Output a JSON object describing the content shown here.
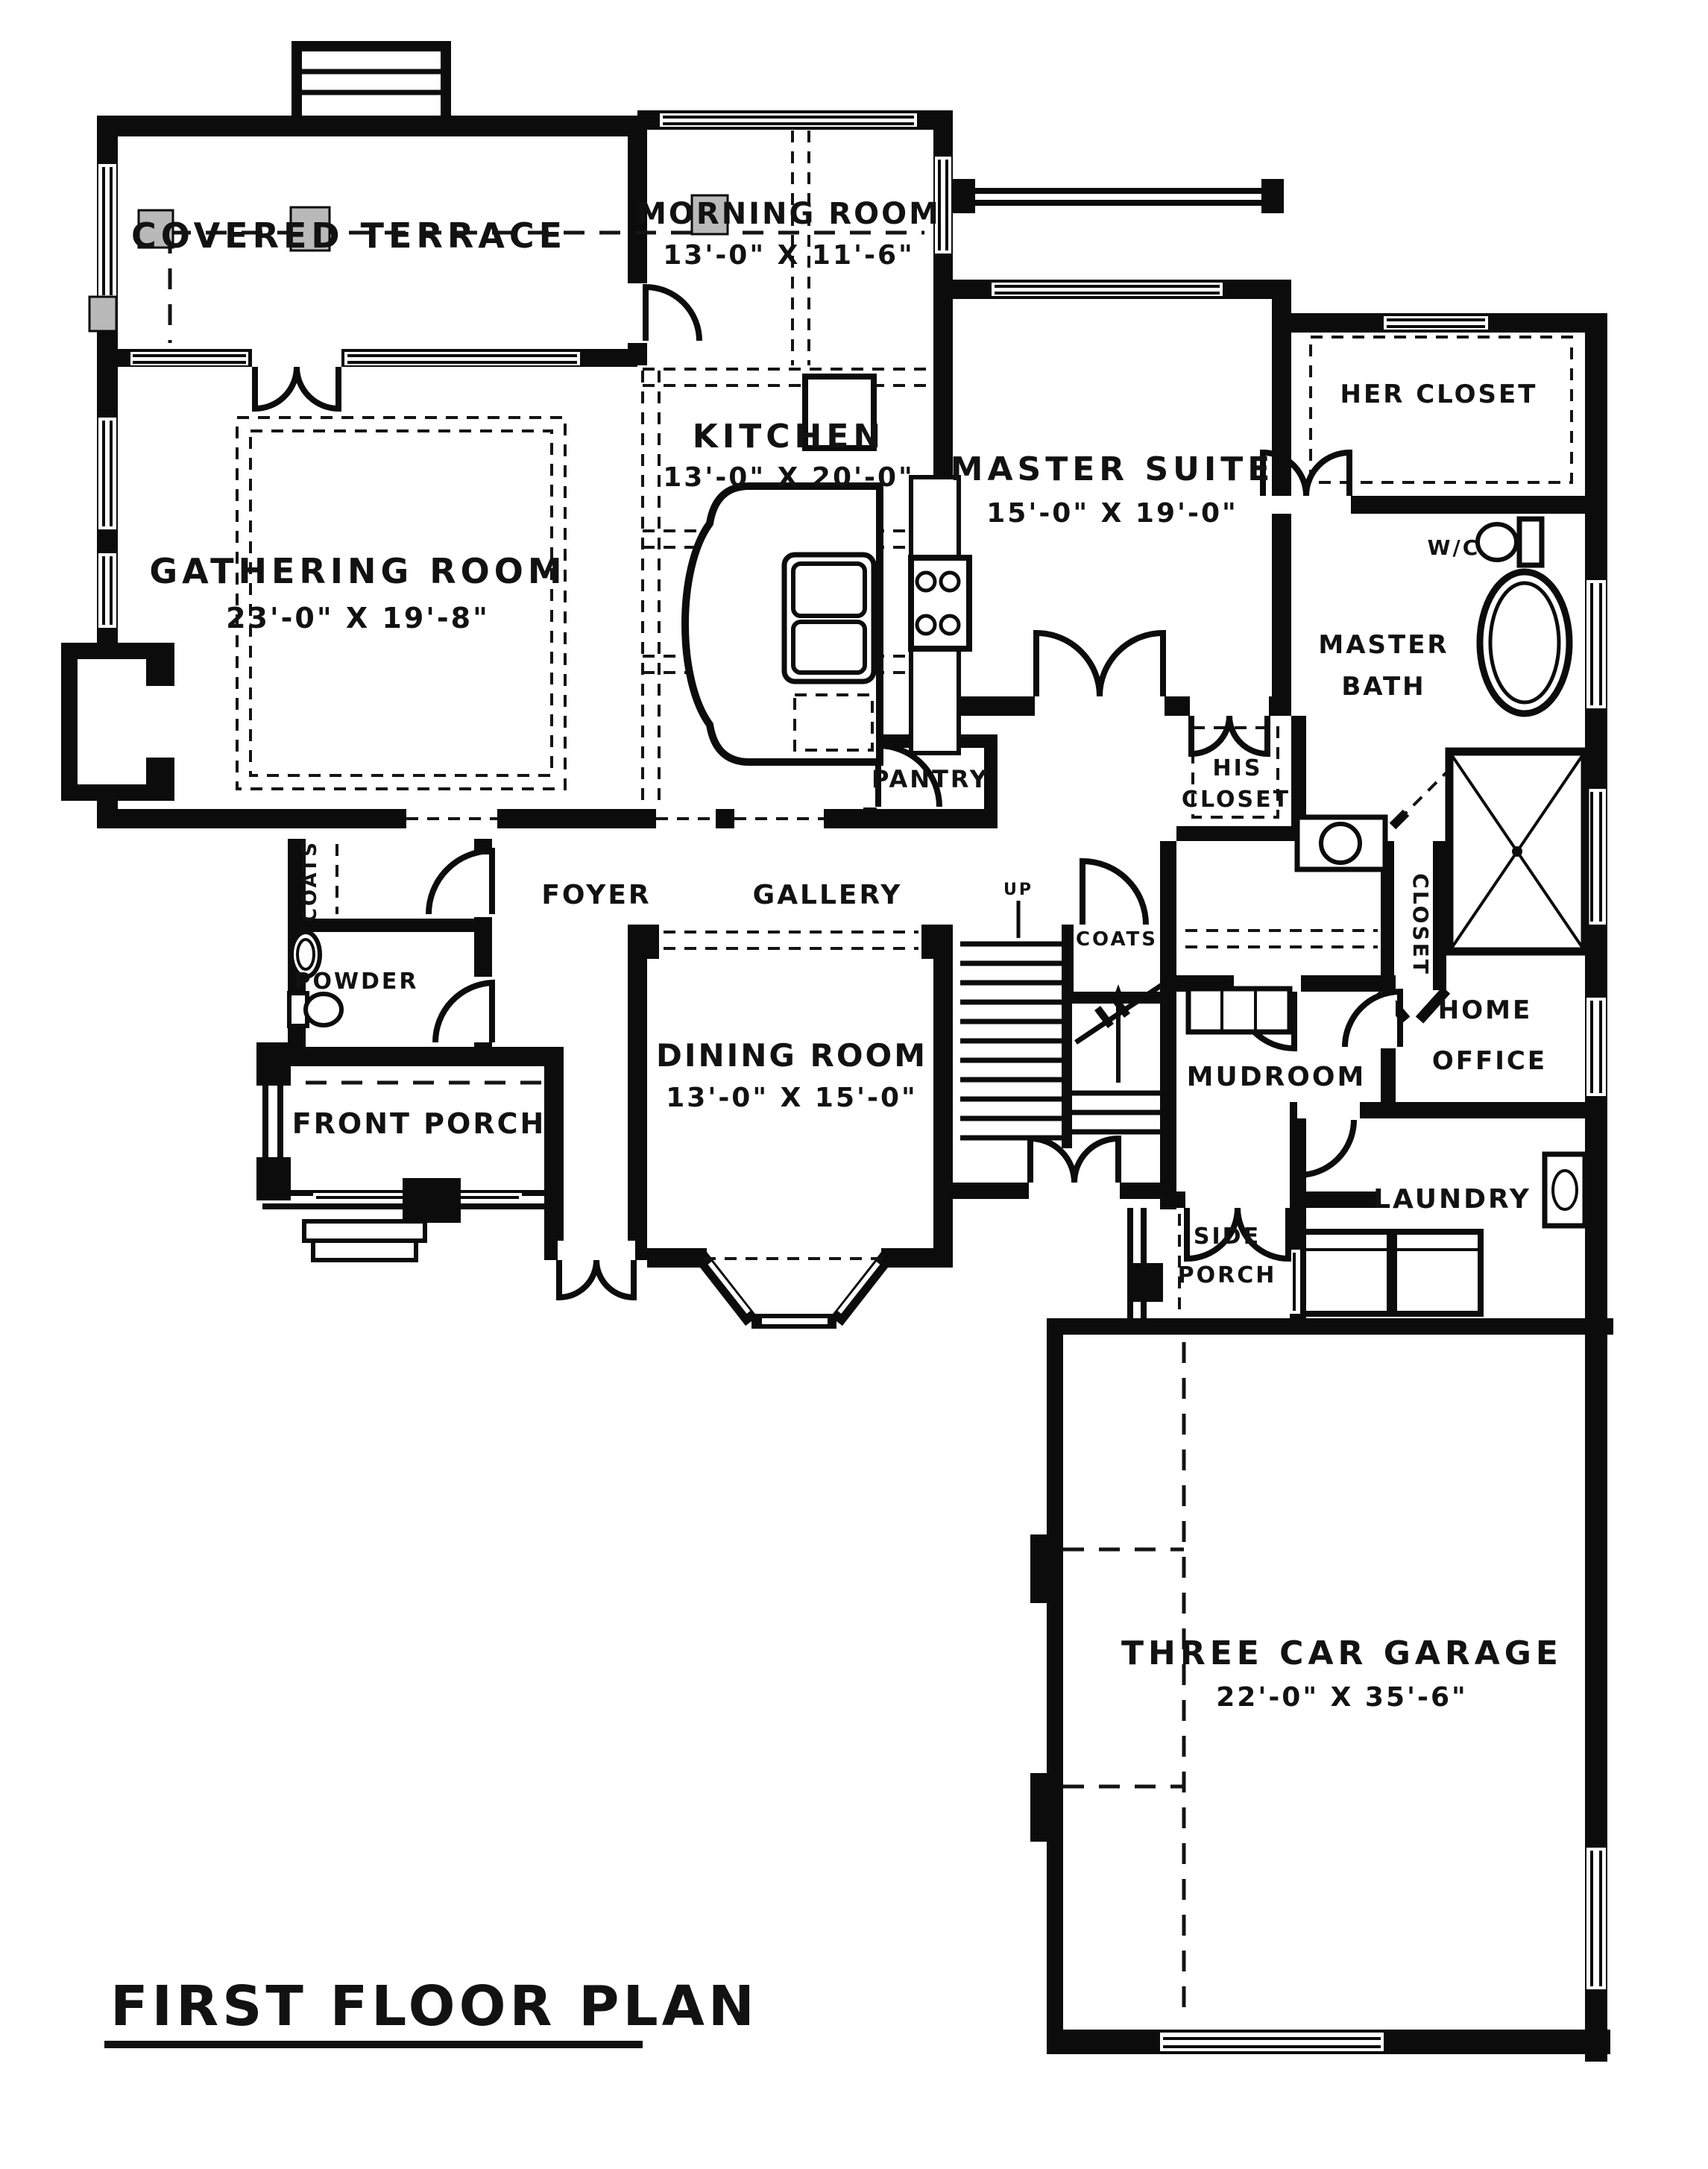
{
  "plan": {
    "title": "FIRST FLOOR PLAN",
    "rooms": {
      "covered_terrace": {
        "name": "COVERED TERRACE"
      },
      "morning_room": {
        "name": "MORNING ROOM",
        "dims": "13'-0\" X 11'-6\""
      },
      "kitchen": {
        "name": "KITCHEN",
        "dims": "13'-0\" X 20'-0\""
      },
      "gathering_room": {
        "name": "GATHERING ROOM",
        "dims": "23'-0\" X 19'-8\""
      },
      "master_suite": {
        "name": "MASTER SUITE",
        "dims": "15'-0\" X 19'-0\""
      },
      "her_closet": {
        "name": "HER CLOSET"
      },
      "water_closet": {
        "name": "W/C"
      },
      "master_bath": {
        "line1": "MASTER",
        "line2": "BATH"
      },
      "his_closet": {
        "line1": "HIS",
        "line2": "CLOSET"
      },
      "hall_closet": {
        "name": "CLOSET"
      },
      "pantry": {
        "name": "PANTRY"
      },
      "foyer": {
        "name": "FOYER"
      },
      "gallery": {
        "name": "GALLERY"
      },
      "stair_coats": {
        "name": "COATS"
      },
      "entry_coats": {
        "name": "COATS"
      },
      "powder": {
        "name": "POWDER"
      },
      "dining_room": {
        "name": "DINING ROOM",
        "dims": "13'-0\" X 15'-0\""
      },
      "front_porch": {
        "name": "FRONT PORCH"
      },
      "mudroom": {
        "name": "MUDROOM"
      },
      "home_office": {
        "line1": "HOME",
        "line2": "OFFICE"
      },
      "laundry": {
        "name": "LAUNDRY"
      },
      "side_porch": {
        "line1": "SIDE",
        "line2": "PORCH"
      },
      "garage": {
        "name": "THREE CAR GARAGE",
        "dims": "22'-0\" X 35'-6\""
      }
    },
    "annotations": {
      "stair_direction": "UP"
    }
  }
}
